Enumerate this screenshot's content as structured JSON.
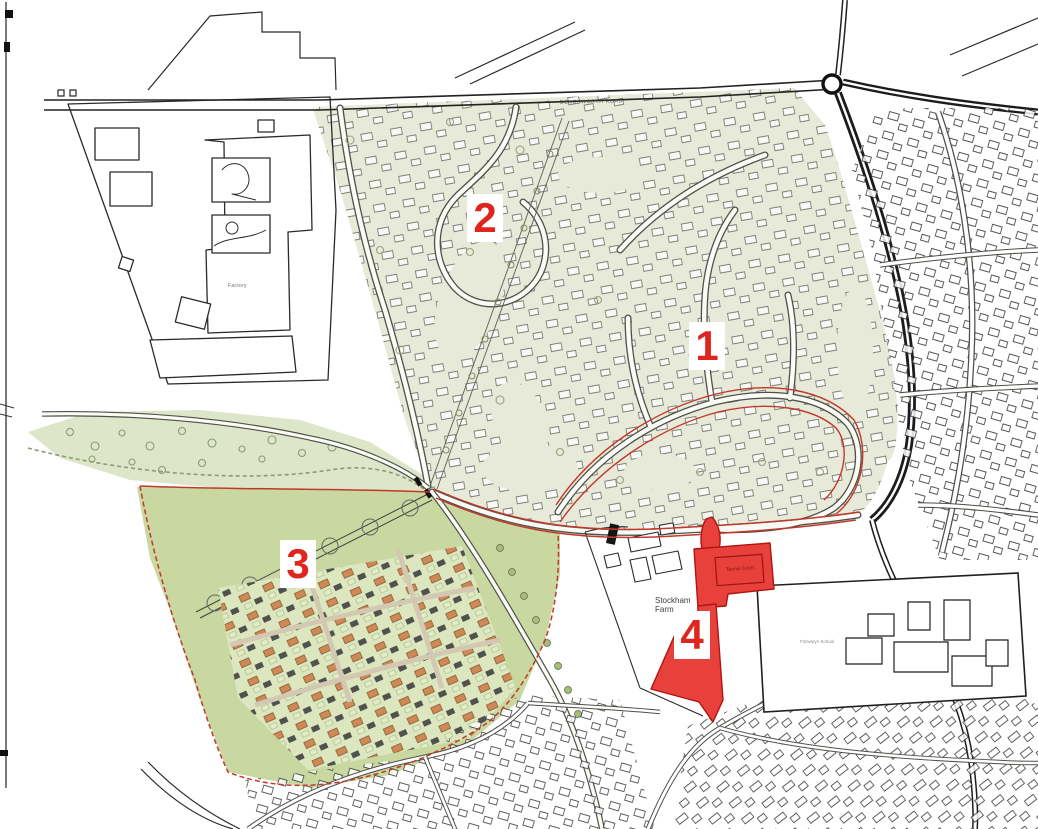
{
  "map": {
    "area_markers": [
      {
        "number": "1"
      },
      {
        "number": "2"
      },
      {
        "number": "3"
      },
      {
        "number": "4"
      }
    ],
    "labels": {
      "road_top": "DENCHWORTH ROAD",
      "factory": "Factory",
      "farm_line1": "Stockham",
      "farm_line2": "Farm",
      "tennis_court": "Tennis Court",
      "school": "Fitzwaryn School"
    },
    "colors": {
      "estate_tint": "#e7ead8",
      "open_space_green": "#dde6c8",
      "site3_green": "#c9d8a0",
      "site3_housing_base": "#dce7c0",
      "site4_red": "#e8403a",
      "site4_border": "#b01512",
      "boundary_red": "#c2392b",
      "marker_red": "#e0251f",
      "linework": "#1f1f1f"
    }
  }
}
